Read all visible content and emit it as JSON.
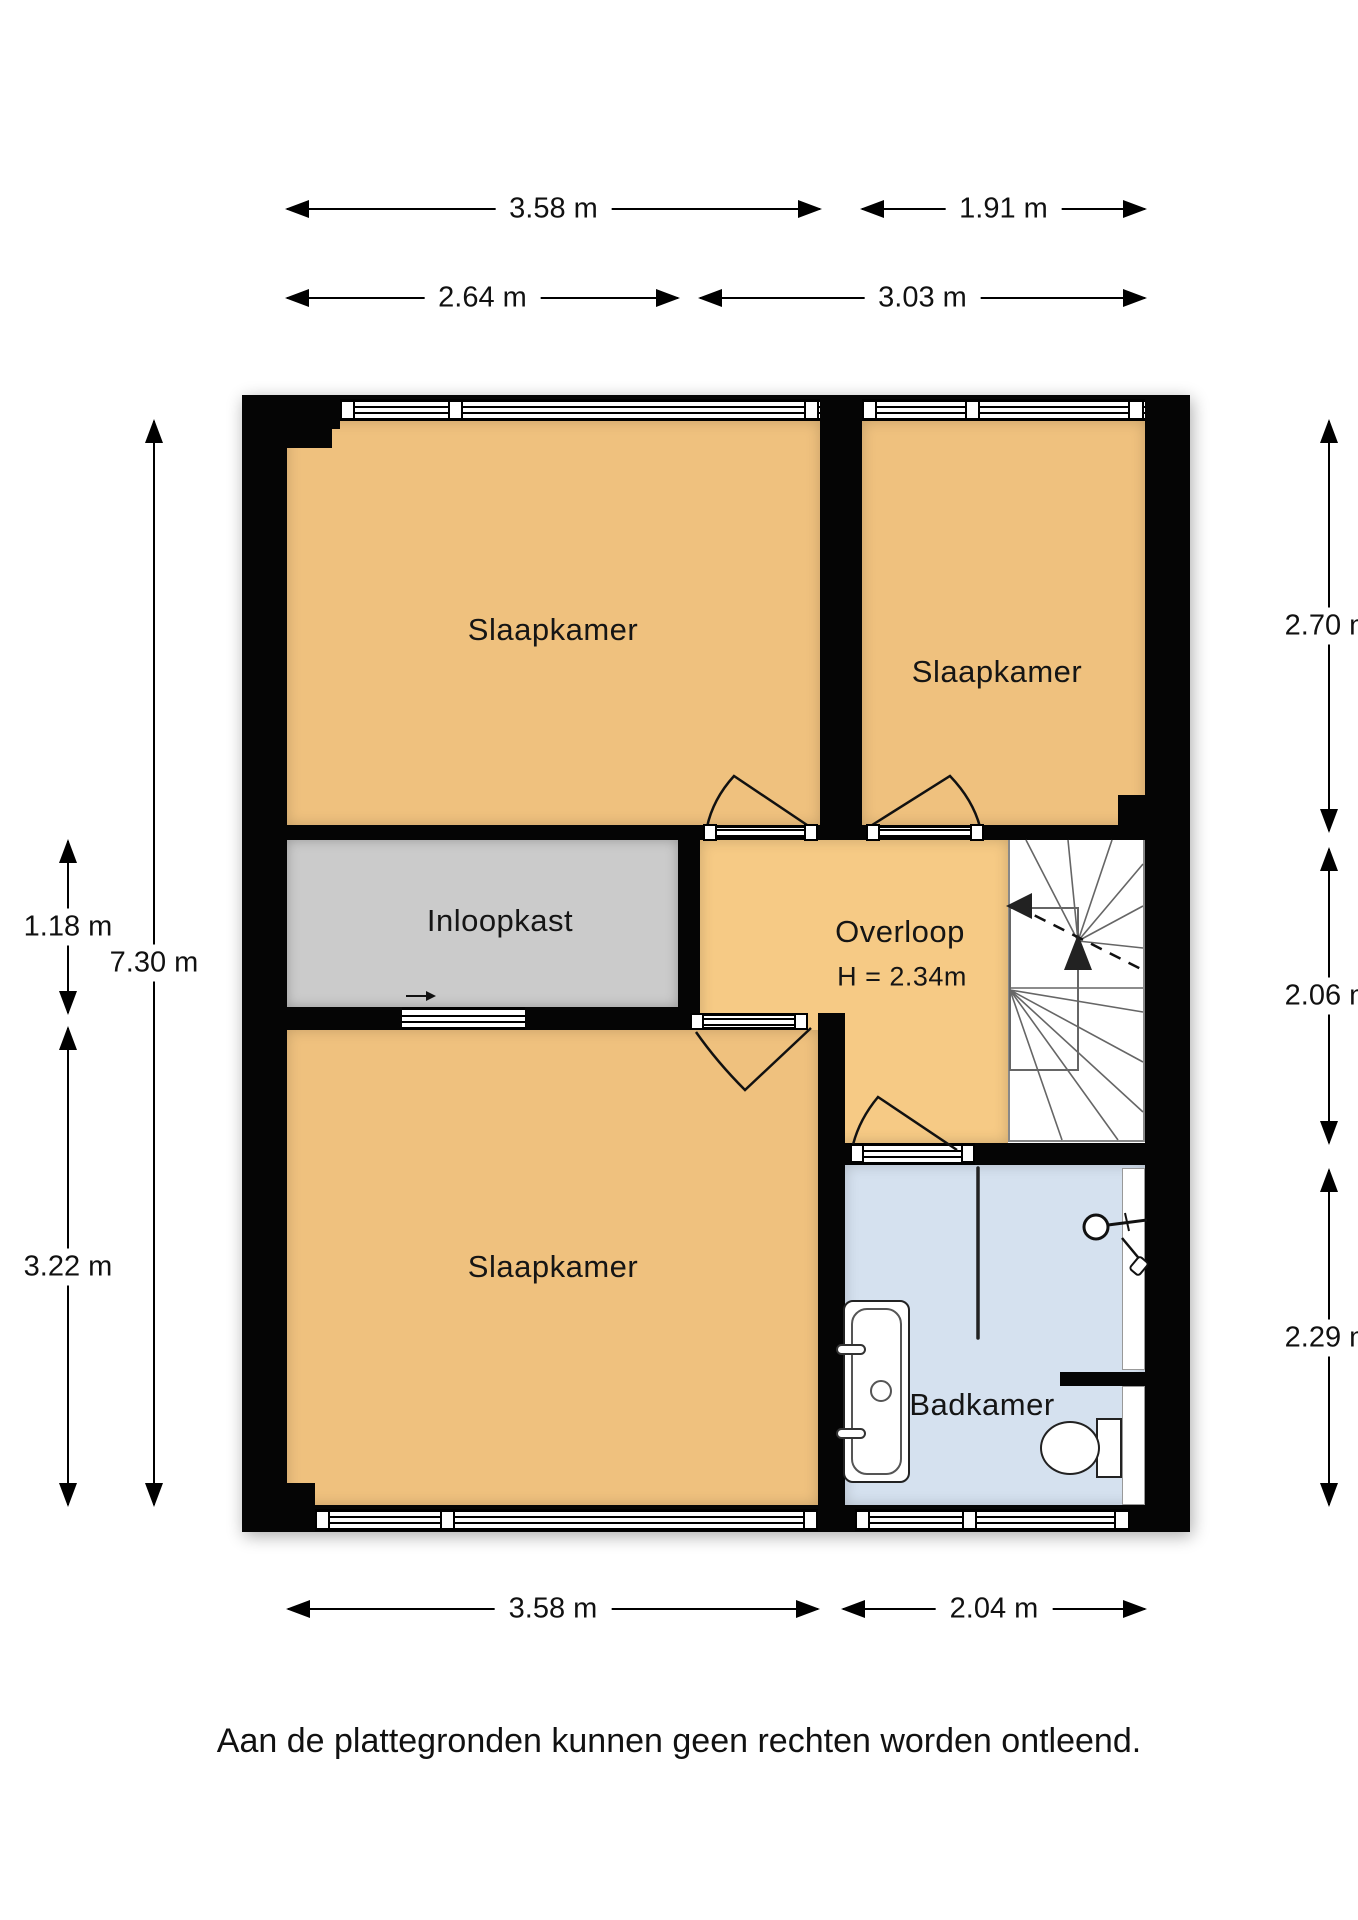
{
  "rooms": {
    "bedroom_top_left": "Slaapkamer",
    "bedroom_top_right": "Slaapkamer",
    "bedroom_bottom_left": "Slaapkamer",
    "walk_in_closet": "Inloopkast",
    "landing": "Overloop",
    "landing_ceiling_height": "H = 2.34m",
    "bathroom": "Badkamer"
  },
  "dimensions": {
    "top_bedroom_width": "3.58 m",
    "top_right_bedroom_width": "1.91 m",
    "closet_width": "2.64 m",
    "landing_width": "3.03 m",
    "left_closet_height": "1.18 m",
    "left_total_height": "7.30 m",
    "left_bedroom_height": "3.22 m",
    "right_bedroom_height": "2.70 m",
    "right_landing_height": "2.06 m",
    "right_bathroom_height": "2.29 m",
    "bottom_bedroom_width": "3.58 m",
    "bottom_bathroom_width": "2.04 m"
  },
  "disclaimer": "Aan de plattegronden kunnen geen rechten worden ontleend.",
  "colors": {
    "room": "#efc17e",
    "landing": "#f6ca85",
    "closet": "#cbcbcb",
    "bath": "#d5e1ef",
    "wall": "#050505"
  }
}
